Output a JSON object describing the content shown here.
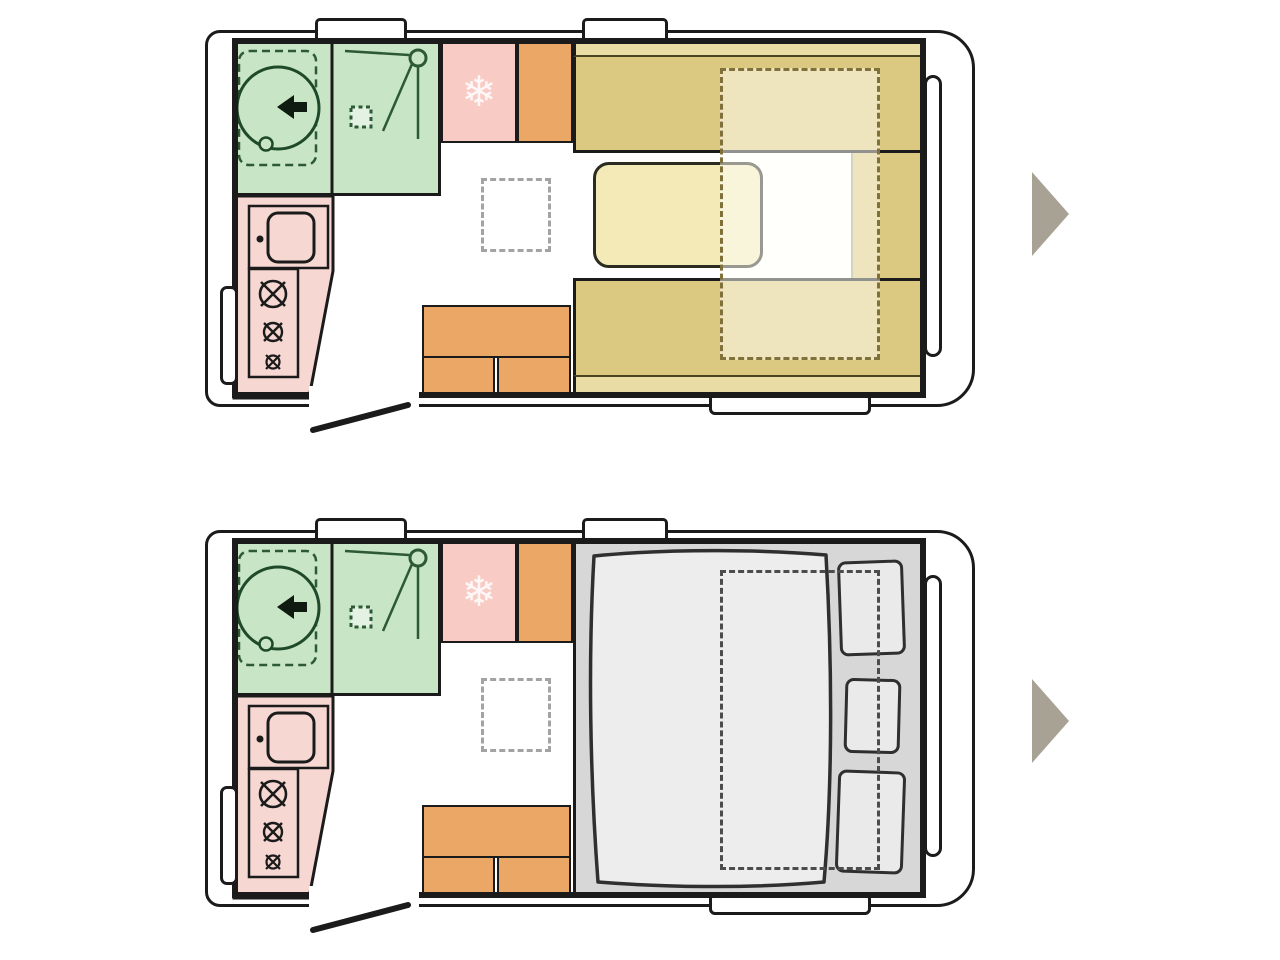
{
  "diagram": {
    "type": "caravan-floorplan",
    "views": [
      {
        "id": "day-layout",
        "description": "seating configuration with U-shaped dinette, table and bed-conversion outline"
      },
      {
        "id": "night-layout",
        "description": "sleeping configuration with double bed, duvet and three pillows"
      }
    ],
    "rooms_and_fixtures": [
      "bathroom-with-toilet-and-shower",
      "kitchen-with-sink-and-three-burner-stove",
      "fridge",
      "wardrobe-cabinets",
      "dinette-benches",
      "dinette-table",
      "bed-conversion-dashed-outline",
      "double-bed",
      "duvet",
      "pillows",
      "skylight-dashed-square",
      "entry-door-ajar",
      "roof-vents",
      "side-windows",
      "entry-step"
    ],
    "pillow_count": 3,
    "roof_vent_count": 2
  },
  "nav": {
    "arrow_direction": "right",
    "arrow_count": 2
  },
  "colors": {
    "wall": "#1b1b1b",
    "bath": "#c8e5c6",
    "bath-line": "#2d5a35",
    "kitchen": "#f6d7d2",
    "fridge": "#f8cbc5",
    "cab": "#eba766",
    "seat": "#dcc981",
    "band": "#e9dca4",
    "table": "#f3eab8",
    "dash-day": "#80703a",
    "bed-base": "#d7d7d7",
    "duvet": "#ededed",
    "pillow": "#eaeaea",
    "skylight-dash": "#a3a3a3",
    "arrow": "#a8a295"
  }
}
